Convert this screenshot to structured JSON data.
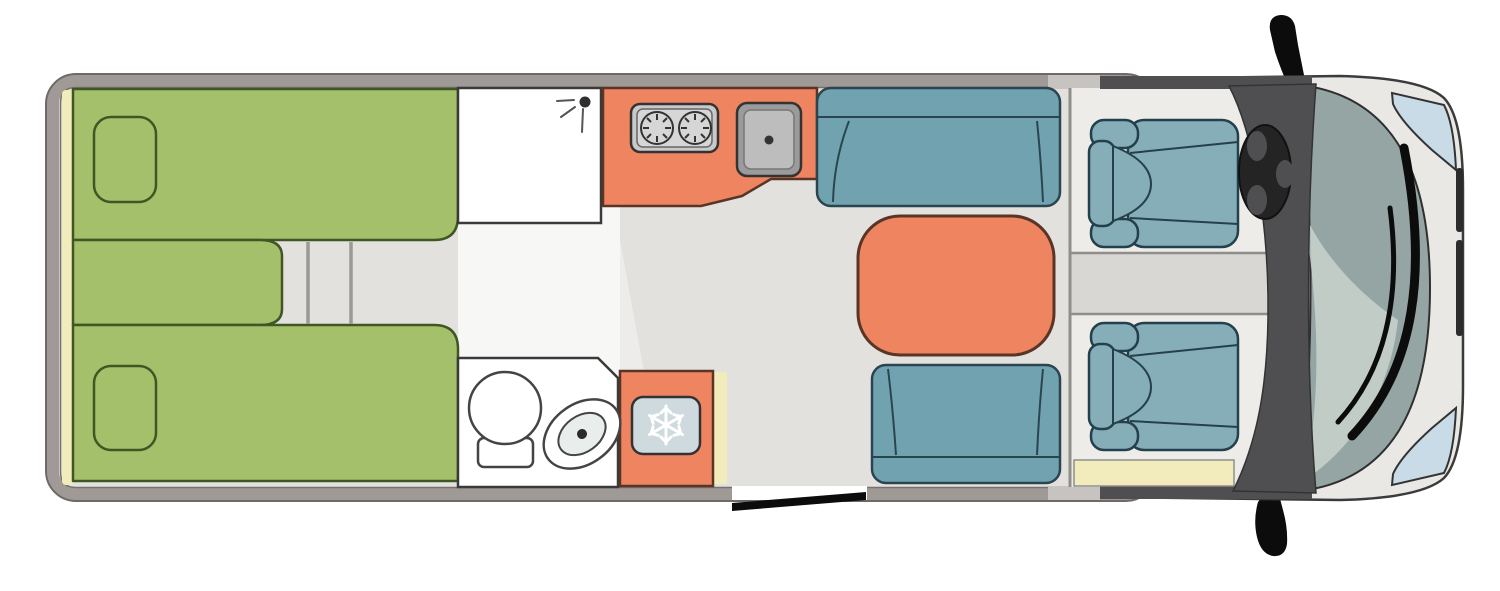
{
  "figure": {
    "kind": "motorhome-floor-plan",
    "view": "top-down",
    "zones": [
      {
        "id": "rear-bedroom",
        "features": [
          "twin-bed-top",
          "twin-bed-bottom",
          "center-cushion",
          "pillow-top",
          "pillow-bottom",
          "step-ladder"
        ]
      },
      {
        "id": "shower-cubicle",
        "features": [
          "shower-head"
        ]
      },
      {
        "id": "kitchen",
        "features": [
          "two-burner-hob",
          "sink"
        ]
      },
      {
        "id": "fridge",
        "features": [
          "freezer-compartment",
          "snowflake"
        ]
      },
      {
        "id": "bathroom",
        "features": [
          "wash-basin",
          "toilet"
        ]
      },
      {
        "id": "dinette",
        "features": [
          "bench-seat-front",
          "table",
          "bench-seat-rear"
        ]
      },
      {
        "id": "cab",
        "features": [
          "cab-seat-driver",
          "cab-seat-passenger",
          "steering-wheel",
          "dashboard",
          "windshield",
          "wipers",
          "headlight-top",
          "headlight-bottom",
          "side-mirror-top",
          "side-mirror-bottom",
          "entry-step"
        ]
      },
      {
        "id": "entry-door",
        "state": "open"
      }
    ]
  },
  "icons": [
    {
      "name": "shower-head-icon",
      "shape": "dot with spray lines"
    },
    {
      "name": "burner-icon",
      "shape": "circle with radial ticks"
    },
    {
      "name": "snowflake-icon",
      "shape": "six-armed snowflake"
    },
    {
      "name": "steering-wheel-icon",
      "shape": "ring with three spokes"
    },
    {
      "name": "side-mirror-icon",
      "shape": "black blade"
    }
  ],
  "palette": {
    "white": "#ffffff",
    "black": "#0c0c0c",
    "wall": "#a09a97",
    "wall_cap": "#c6c3c0",
    "floor": "#e2e1de",
    "floor_cab": "#edece9",
    "floor_white": "#f7f7f5",
    "floor_step": "#d8d7d3",
    "bed_green": "#a5c06a",
    "bed_outline": "#3f5724",
    "trim_yellow": "#f2ecbc",
    "orange": "#ee8560",
    "orange_outline": "#5a3526",
    "appliance": "#c9c9c9",
    "appliance_light": "#d6d6d6",
    "sink_gray": "#9b9b9b",
    "sink_inner": "#bdbdbd",
    "freezer_blue": "#cfdadf",
    "toilet_inner": "#e9edeb",
    "bench_teal": "#71a2b0",
    "seat_teal": "#85aeb9",
    "seat_outline": "#2b4550",
    "dashboard": "#4f4f51",
    "wheel_black": "#242424",
    "grille_dark": "#2c2c2c",
    "windshield": "#95a5a4",
    "windshield_highlight": "#c9d2ce",
    "body_gray": "#eae8e4",
    "headlight_blue": "#c8dbe6"
  }
}
